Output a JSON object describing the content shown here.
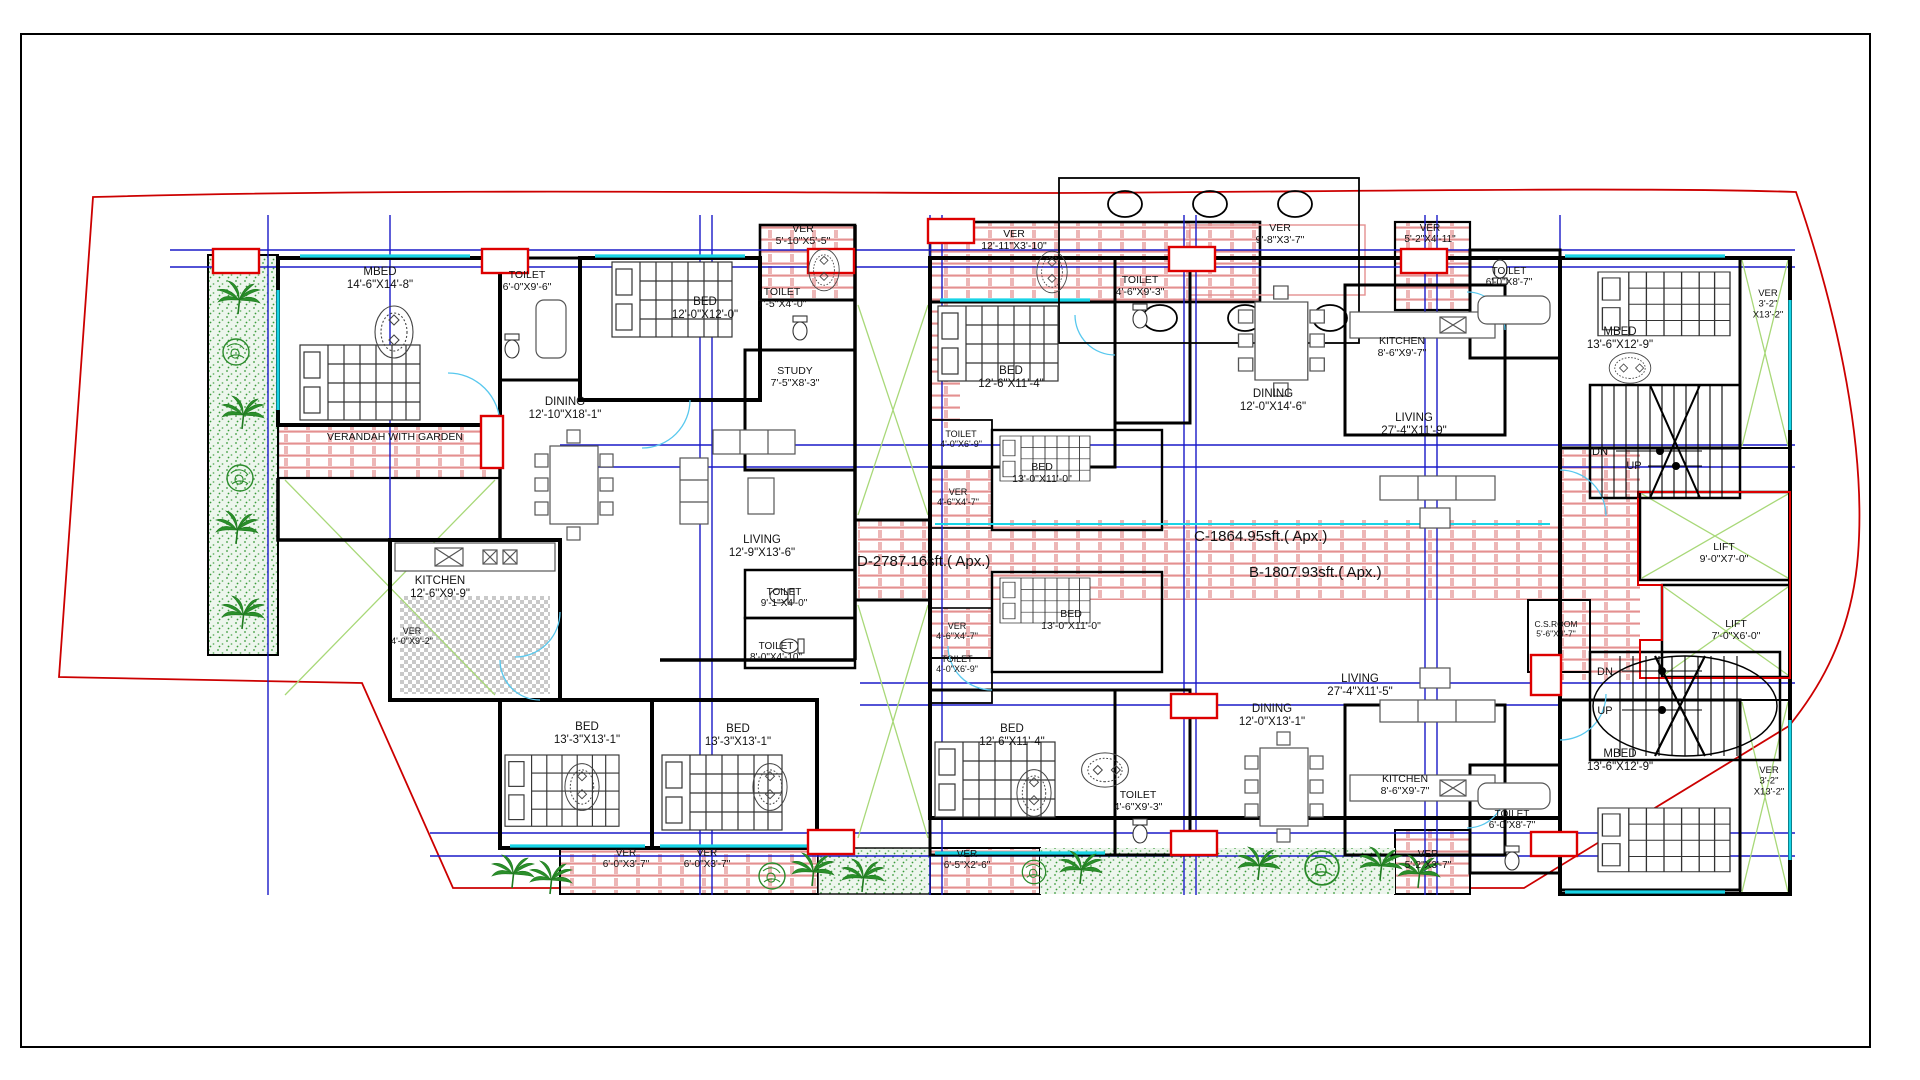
{
  "drawing": {
    "type": "residential-floor-plan",
    "units": [
      "D",
      "C",
      "B"
    ]
  },
  "colors": {
    "boundary": "#cc0000",
    "wall": "#000000",
    "grid_blue": "#1a1ac8",
    "window_cyan": "#18d4e6",
    "veranda_pink": "#e08585",
    "garden_green": "#2a8a2a",
    "light_green": "#a8d878",
    "area_text": "#b400b4",
    "kitchen_hatch": "#c8c8c8"
  },
  "area_labels": [
    {
      "text": "D-2787.16sft.( Apx.)",
      "x": 857,
      "y": 566
    },
    {
      "text": "C-1864.95sft.( Apx.)",
      "x": 1194,
      "y": 541
    },
    {
      "text": "B-1807.93sft.( Apx.)",
      "x": 1249,
      "y": 577
    }
  ],
  "labels": [
    {
      "name": "room-label-mbed-d",
      "lines": [
        "MBED",
        "14'-6\"X14'-8\""
      ],
      "x": 380,
      "y": 275
    },
    {
      "name": "room-label-toilet-d1",
      "lines": [
        "TOILET",
        "6'-0\"X9'-6\""
      ],
      "x": 527,
      "y": 278,
      "size": 10.5
    },
    {
      "name": "room-label-bed-d",
      "lines": [
        "BED",
        "12'-0\"X12'-0\""
      ],
      "x": 705,
      "y": 305
    },
    {
      "name": "room-label-ver-d-top",
      "lines": [
        "VER",
        "5'-10\"X5'-5\""
      ],
      "x": 803,
      "y": 232,
      "size": 10.5
    },
    {
      "name": "room-label-toilet-d2",
      "lines": [
        "TOILET",
        "7'-5\"X4'-0\""
      ],
      "x": 782,
      "y": 295,
      "size": 10.5
    },
    {
      "name": "room-label-study",
      "lines": [
        "STUDY",
        "7'-5\"X8'-3\""
      ],
      "x": 795,
      "y": 374,
      "size": 10.5
    },
    {
      "name": "room-label-dining-d",
      "lines": [
        "DINING",
        "12'-10\"X18'-1\""
      ],
      "x": 565,
      "y": 405
    },
    {
      "name": "room-label-verandah-garden",
      "lines": [
        "VERANDAH WITH GARDEN"
      ],
      "x": 395,
      "y": 440,
      "size": 10.5
    },
    {
      "name": "room-label-kitchen-d",
      "lines": [
        "KITCHEN",
        "12'-6\"X9'-9\""
      ],
      "x": 440,
      "y": 584
    },
    {
      "name": "room-label-ver-d-left",
      "lines": [
        "VER",
        "4'-0\"X9'-2\""
      ],
      "x": 412,
      "y": 634,
      "size": 9
    },
    {
      "name": "room-label-living-d",
      "lines": [
        "LIVING",
        "12'-9\"X13'-6\""
      ],
      "x": 762,
      "y": 543
    },
    {
      "name": "room-label-toilet-d3",
      "lines": [
        "TOILET",
        "9'-1\"X4'-0\""
      ],
      "x": 784,
      "y": 595,
      "size": 10
    },
    {
      "name": "room-label-toilet-d4",
      "lines": [
        "TOILET",
        "8'-0\"X4'-10\""
      ],
      "x": 776,
      "y": 649,
      "size": 10
    },
    {
      "name": "room-label-bed-d-bl1",
      "lines": [
        "BED",
        "13'-3\"X13'-1\""
      ],
      "x": 587,
      "y": 730
    },
    {
      "name": "room-label-bed-d-bl2",
      "lines": [
        "BED",
        "13'-3\"X13'-1\""
      ],
      "x": 738,
      "y": 732
    },
    {
      "name": "room-label-ver-bl1",
      "lines": [
        "VER",
        "6'-0\"X3'-7\""
      ],
      "x": 626,
      "y": 856,
      "size": 10
    },
    {
      "name": "room-label-ver-bl2",
      "lines": [
        "VER",
        "6'-0\"X3'-7\""
      ],
      "x": 707,
      "y": 856,
      "size": 10
    },
    {
      "name": "room-label-ver-c-top",
      "lines": [
        "VER",
        "12'-11\"X3'-10\""
      ],
      "x": 1014,
      "y": 237,
      "size": 10.5
    },
    {
      "name": "room-label-bed-c",
      "lines": [
        "BED",
        "12'-6\"X11'-4\""
      ],
      "x": 1011,
      "y": 374
    },
    {
      "name": "room-label-toilet-c-small",
      "lines": [
        "TOILET",
        "4'-0\"X6'-9\""
      ],
      "x": 961,
      "y": 437,
      "size": 9
    },
    {
      "name": "room-label-ver-c-small",
      "lines": [
        "VER",
        "4'-6\"X4'-7\""
      ],
      "x": 958,
      "y": 495,
      "size": 9
    },
    {
      "name": "room-label-bed-c2",
      "lines": [
        "BED",
        "13'-0\"X11'-0\""
      ],
      "x": 1042,
      "y": 470,
      "size": 10.5
    },
    {
      "name": "room-label-toilet-c",
      "lines": [
        "TOILET",
        "4'-6\"X9'-3\""
      ],
      "x": 1140,
      "y": 283,
      "size": 10.5
    },
    {
      "name": "room-label-ver-c-entry",
      "lines": [
        "VER",
        "9'-8\"X3'-7\""
      ],
      "x": 1280,
      "y": 231,
      "size": 10.5
    },
    {
      "name": "room-label-dining-c",
      "lines": [
        "DINING",
        "12'-0\"X14'-6\""
      ],
      "x": 1273,
      "y": 397
    },
    {
      "name": "room-label-kitchen-c",
      "lines": [
        "KITCHEN",
        "8'-6\"X9'-7\""
      ],
      "x": 1402,
      "y": 344,
      "size": 10.5
    },
    {
      "name": "room-label-living-c",
      "lines": [
        "LIVING",
        "27'-4\"X11'-9\""
      ],
      "x": 1414,
      "y": 421
    },
    {
      "name": "room-label-toilet-c-right",
      "lines": [
        "TOILET",
        "6'-0\"X8'-7\""
      ],
      "x": 1509,
      "y": 274,
      "size": 10
    },
    {
      "name": "room-label-ver-c-right",
      "lines": [
        "VER",
        "5'-2\"X4'-11\""
      ],
      "x": 1430,
      "y": 231,
      "size": 10
    },
    {
      "name": "room-label-mbed-top-right",
      "lines": [
        "MBED",
        "13'-6\"X12'-9\""
      ],
      "x": 1620,
      "y": 335
    },
    {
      "name": "room-label-ver-right-top",
      "lines": [
        "VER",
        "3'-2\"",
        "X13'-2\""
      ],
      "x": 1768,
      "y": 296,
      "size": 9.5
    },
    {
      "name": "stair-label-dn-top",
      "lines": [
        "DN"
      ],
      "x": 1600,
      "y": 455,
      "size": 11
    },
    {
      "name": "stair-label-up-top",
      "lines": [
        "UP"
      ],
      "x": 1634,
      "y": 469,
      "size": 11
    },
    {
      "name": "room-label-lift1",
      "lines": [
        "LIFT",
        "9'-0\"X7'-0\""
      ],
      "x": 1724,
      "y": 550,
      "size": 10.5
    },
    {
      "name": "room-label-lift2",
      "lines": [
        "LIFT",
        "7'-0\"X6'-0\""
      ],
      "x": 1736,
      "y": 627,
      "size": 10.5
    },
    {
      "name": "room-label-csroom",
      "lines": [
        "C.S.ROOM",
        "5'-6\"X4'-7\""
      ],
      "x": 1556,
      "y": 627,
      "size": 8.5
    },
    {
      "name": "stair-label-dn-bottom",
      "lines": [
        "DN"
      ],
      "x": 1605,
      "y": 675,
      "size": 11
    },
    {
      "name": "stair-label-up-bottom",
      "lines": [
        "UP"
      ],
      "x": 1605,
      "y": 714,
      "size": 11
    },
    {
      "name": "room-label-bed-b2",
      "lines": [
        "BED",
        "13'-0\"X11'-0\""
      ],
      "x": 1071,
      "y": 617,
      "size": 10.5
    },
    {
      "name": "room-label-ver-b-small",
      "lines": [
        "VER",
        "4'-6\"X4'-7\""
      ],
      "x": 957,
      "y": 629,
      "size": 9
    },
    {
      "name": "room-label-toilet-b-small",
      "lines": [
        "TOILET",
        "4'-0\"X6'-9\""
      ],
      "x": 957,
      "y": 662,
      "size": 9
    },
    {
      "name": "room-label-bed-b",
      "lines": [
        "BED",
        "12'-6\"X11'-4\""
      ],
      "x": 1012,
      "y": 732
    },
    {
      "name": "room-label-toilet-b",
      "lines": [
        "TOILET",
        "4'-6\"X9'-3\""
      ],
      "x": 1138,
      "y": 798,
      "size": 10.5
    },
    {
      "name": "room-label-ver-b-entry",
      "lines": [
        "VER",
        "6'-5\"X2'-6\""
      ],
      "x": 967,
      "y": 857,
      "size": 10
    },
    {
      "name": "room-label-dining-b",
      "lines": [
        "DINING",
        "12'-0\"X13'-1\""
      ],
      "x": 1272,
      "y": 712
    },
    {
      "name": "room-label-living-b",
      "lines": [
        "LIVING",
        "27'-4\"X11'-5\""
      ],
      "x": 1360,
      "y": 682
    },
    {
      "name": "room-label-kitchen-b",
      "lines": [
        "KITCHEN",
        "8'-6\"X9'-7\""
      ],
      "x": 1405,
      "y": 782,
      "size": 10.5
    },
    {
      "name": "room-label-toilet-b-right",
      "lines": [
        "TOILET",
        "6'-0\"X8'-7\""
      ],
      "x": 1512,
      "y": 817,
      "size": 10
    },
    {
      "name": "room-label-ver-b-right",
      "lines": [
        "VER",
        "5'-2\"X3'-7\""
      ],
      "x": 1428,
      "y": 857,
      "size": 10
    },
    {
      "name": "room-label-mbed-bottom-right",
      "lines": [
        "MBED",
        "13'-6\"X12'-9\""
      ],
      "x": 1620,
      "y": 757
    },
    {
      "name": "room-label-ver-right-bottom",
      "lines": [
        "VER",
        "3'-2\"",
        "X13'-2\""
      ],
      "x": 1769,
      "y": 773,
      "size": 9.5
    }
  ]
}
